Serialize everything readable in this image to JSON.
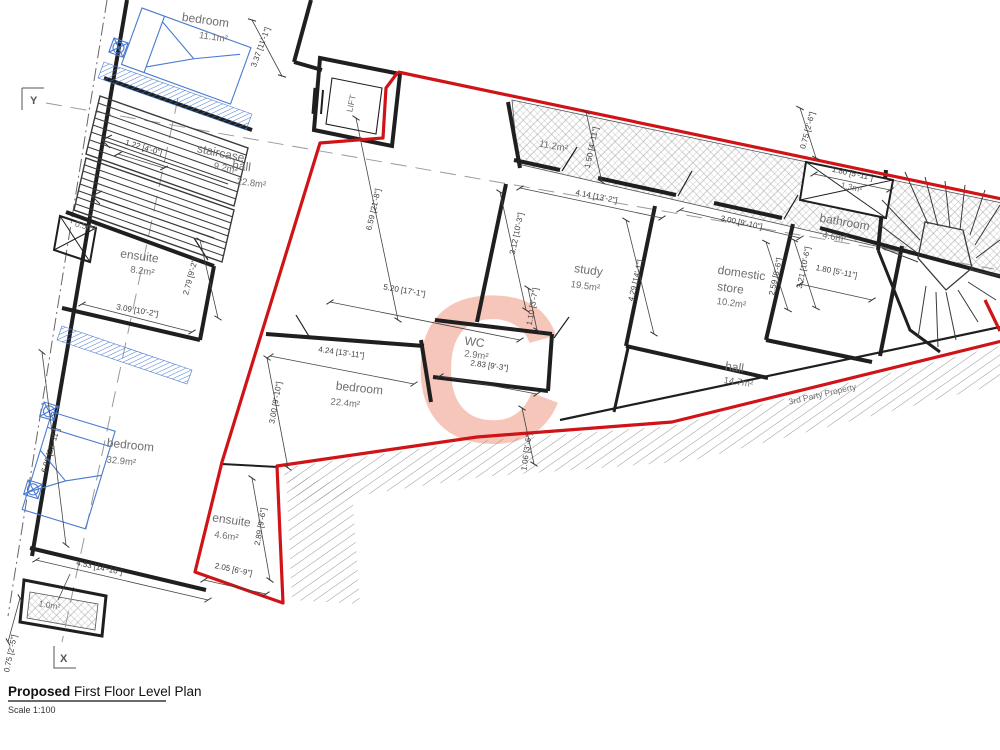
{
  "title": {
    "bold": "Proposed",
    "rest": " First Floor Level Plan",
    "scale": "Scale 1:100"
  },
  "axes": {
    "x": "X",
    "y": "Y"
  },
  "notes": {
    "third_party": "3rd Party Property"
  },
  "watermark": {
    "letter": "C",
    "color": "#f5bdae"
  },
  "colors": {
    "boundary": "#d01317",
    "furniture": "#4a7ad0"
  },
  "rooms": [
    {
      "name": "bedroom",
      "area": "11.1m²"
    },
    {
      "name": "staircase",
      "area": "9.2m²"
    },
    {
      "name": "hall",
      "area": "22.8m²"
    },
    {
      "name": "ensuite",
      "area": "8.2m²"
    },
    {
      "name": "bedroom",
      "area": "32.9m²"
    },
    {
      "name": "ensuite",
      "area": "4.6m²"
    },
    {
      "name": "bedroom",
      "area": "22.4m²"
    },
    {
      "name": "WC",
      "area": "2.9m²"
    },
    {
      "name": "study",
      "area": "19.5m²"
    },
    {
      "name": "domestic",
      "name2": "store",
      "area": "10.2m²"
    },
    {
      "name": "bathroom",
      "area": "4.6m²"
    },
    {
      "name": "hall",
      "area": "14.7m²"
    },
    {
      "name": "LIFT"
    }
  ],
  "areas": {
    "top_void": "11.2m²",
    "store_small": "1.3m²",
    "porch": "1.0m²",
    "shaft": "0.5m²"
  },
  "dims": [
    "3.37 [11'-1\"]",
    "1.22 [4'-0\"]",
    "3.09 [10'-2\"]",
    "2.79 [9'-2\"]",
    "6.99 [22'-11\"]",
    "4.53 [14'-10\"]",
    "0.75 [2'-5\"]",
    "2.05 [6'-9\"]",
    "2.89 [9'-6\"]",
    "3.00 [9'-10\"]",
    "4.24 [13'-11\"]",
    "2.83 [9'-3\"]",
    "1.06 [3'-6\"]",
    "5.20 [17'-1\"]",
    "6.59 [21'-8\"]",
    "1.50 [4'-11\"]",
    "4.14 [13'-2\"]",
    "3.12 [10'-3\"]",
    "1.10 [3'-7\"]",
    "4.29 [14'-1\"]",
    "3.00 [9'-10\"]",
    "2.59 [8'-6\"]",
    "3.21 [10'-6\"]",
    "1.80 [5'-11\"]",
    "1.80 [5'-11\"]",
    "0.75 [2'-6\"]"
  ]
}
